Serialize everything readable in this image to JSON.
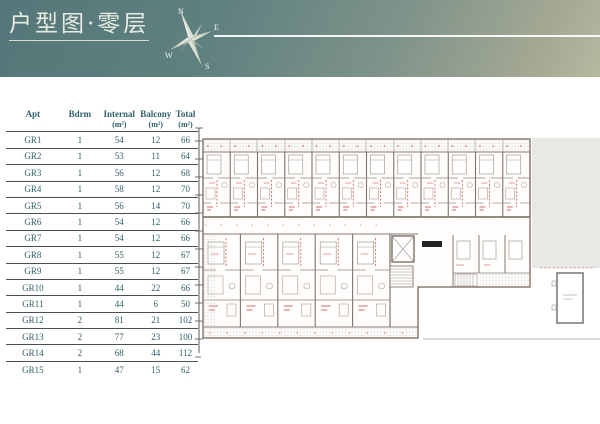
{
  "header": {
    "title": "户型图·零层",
    "compass": {
      "north": "N",
      "east": "E",
      "south": "S",
      "west": "W"
    }
  },
  "icons": {
    "compass": "compass-rose-icon"
  },
  "table": {
    "columns": [
      {
        "label": "Apt",
        "unit": ""
      },
      {
        "label": "Bdrm",
        "unit": ""
      },
      {
        "label": "Internal",
        "unit": "(m²)"
      },
      {
        "label": "Balcony",
        "unit": "(m²)"
      },
      {
        "label": "Total",
        "unit": "(m²)"
      }
    ],
    "rows": [
      {
        "apt": "GR1",
        "bdrm": "1",
        "internal": "54",
        "balcony": "12",
        "total": "66"
      },
      {
        "apt": "GR2",
        "bdrm": "1",
        "internal": "53",
        "balcony": "11",
        "total": "64"
      },
      {
        "apt": "GR3",
        "bdrm": "1",
        "internal": "56",
        "balcony": "12",
        "total": "68"
      },
      {
        "apt": "GR4",
        "bdrm": "1",
        "internal": "58",
        "balcony": "12",
        "total": "70"
      },
      {
        "apt": "GR5",
        "bdrm": "1",
        "internal": "56",
        "balcony": "14",
        "total": "70"
      },
      {
        "apt": "GR6",
        "bdrm": "1",
        "internal": "54",
        "balcony": "12",
        "total": "66"
      },
      {
        "apt": "GR7",
        "bdrm": "1",
        "internal": "54",
        "balcony": "12",
        "total": "66"
      },
      {
        "apt": "GR8",
        "bdrm": "1",
        "internal": "55",
        "balcony": "12",
        "total": "67"
      },
      {
        "apt": "GR9",
        "bdrm": "1",
        "internal": "55",
        "balcony": "12",
        "total": "67"
      },
      {
        "apt": "GR10",
        "bdrm": "1",
        "internal": "44",
        "balcony": "22",
        "total": "66"
      },
      {
        "apt": "GR11",
        "bdrm": "1",
        "internal": "44",
        "balcony": "6",
        "total": "50"
      },
      {
        "apt": "GR12",
        "bdrm": "2",
        "internal": "81",
        "balcony": "21",
        "total": "102"
      },
      {
        "apt": "GR13",
        "bdrm": "2",
        "internal": "77",
        "balcony": "23",
        "total": "100"
      },
      {
        "apt": "GR14",
        "bdrm": "2",
        "internal": "68",
        "balcony": "44",
        "total": "112"
      },
      {
        "apt": "GR15",
        "bdrm": "1",
        "internal": "47",
        "balcony": "15",
        "total": "62"
      }
    ]
  },
  "colors": {
    "header_gradient_start": "#557779",
    "header_gradient_end": "#b7b8a0",
    "table_text": "#2f5f68",
    "plan_annotation_red": "#c23b32",
    "plan_wall": "#7e7468",
    "site_area_gray": "#e8e8e5"
  }
}
